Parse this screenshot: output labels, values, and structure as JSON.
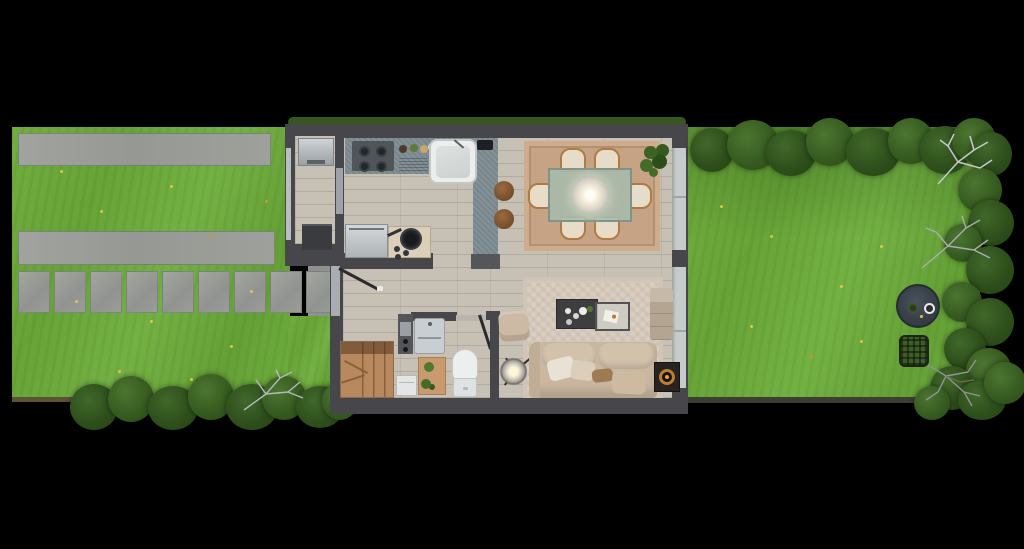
{
  "scene": {
    "type": "floor-plan-3d-top-view",
    "visible_text": [],
    "background_color": "#000000",
    "palette": {
      "grass": "#6fab3e",
      "grass_shadow": "#5d9a33",
      "hedge": "#2e4f1c",
      "concrete": "#9c9e99",
      "wall": "#47474b",
      "wood_floor": "#c6c0b5",
      "kitchen_counter": "#7e8c92",
      "cooker_unit": "#dbcfb9",
      "steel_appliance": "#c3c7ca",
      "dining_rug": "#c5a384",
      "living_rug": "#d8cec1",
      "sofa": "#c9b7a1",
      "stairs_wood": "#b8895e",
      "glass_wall": "#c7cbca",
      "lamp_glow": "#fff7e0",
      "garden_table": "#3b424c",
      "amber_accent": "#b97e2e",
      "sanitary_white": "#ecefee"
    },
    "front_garden": {
      "features": [
        "lawn",
        "driveway-strip",
        "driveway-strip",
        "paver-path",
        "front-porch",
        "hedge-row",
        "dry-branch",
        "dandelions"
      ],
      "paver_count": 9,
      "driveway_strip_count": 2
    },
    "house": {
      "rooms": [
        {
          "name": "storage-room",
          "items": [
            "top-load-appliance",
            "dark-cabinet",
            "side-window"
          ]
        },
        {
          "name": "kitchen",
          "items": [
            "gas-hob-4-burner",
            "drainboard",
            "counter-bowls",
            "sink-with-faucet",
            "toaster",
            "breakfast-bar-peninsula",
            "bar-stool",
            "bar-stool",
            "stainless-dishwasher",
            "cooker-with-frying-pan"
          ]
        },
        {
          "name": "hallway",
          "items": [
            "front-door-open",
            "winder-staircase",
            "white-appliance"
          ]
        },
        {
          "name": "wc",
          "items": [
            "tall-cabinet",
            "washbasin",
            "toilet",
            "plant-side-table",
            "door-open"
          ]
        },
        {
          "name": "dining-room",
          "items": [
            "glass-dining-table",
            "pendant-lamp",
            "dining-chair",
            "dining-chair",
            "dining-chair",
            "dining-chair",
            "dining-chair",
            "dining-chair",
            "area-rug",
            "potted-plant"
          ]
        },
        {
          "name": "living-room",
          "items": [
            "sofa-with-pillows",
            "dark-coffee-table",
            "glass-coffee-table",
            "armchair-pouf",
            "tripod-floor-lamp",
            "bench-daybed",
            "amber-side-table",
            "area-rug"
          ]
        }
      ],
      "dining_chair_count": 6,
      "bar_stool_count": 2,
      "glazing": "full-height-glass-wall-to-back-garden"
    },
    "back_garden": {
      "features": [
        "lawn",
        "hedge-top-row",
        "hedge-right-row",
        "hedge-bottom-corner",
        "bistro-table",
        "table-cup",
        "table-plant",
        "wire-basket",
        "dry-branches",
        "dandelions",
        "fence-line"
      ]
    }
  }
}
